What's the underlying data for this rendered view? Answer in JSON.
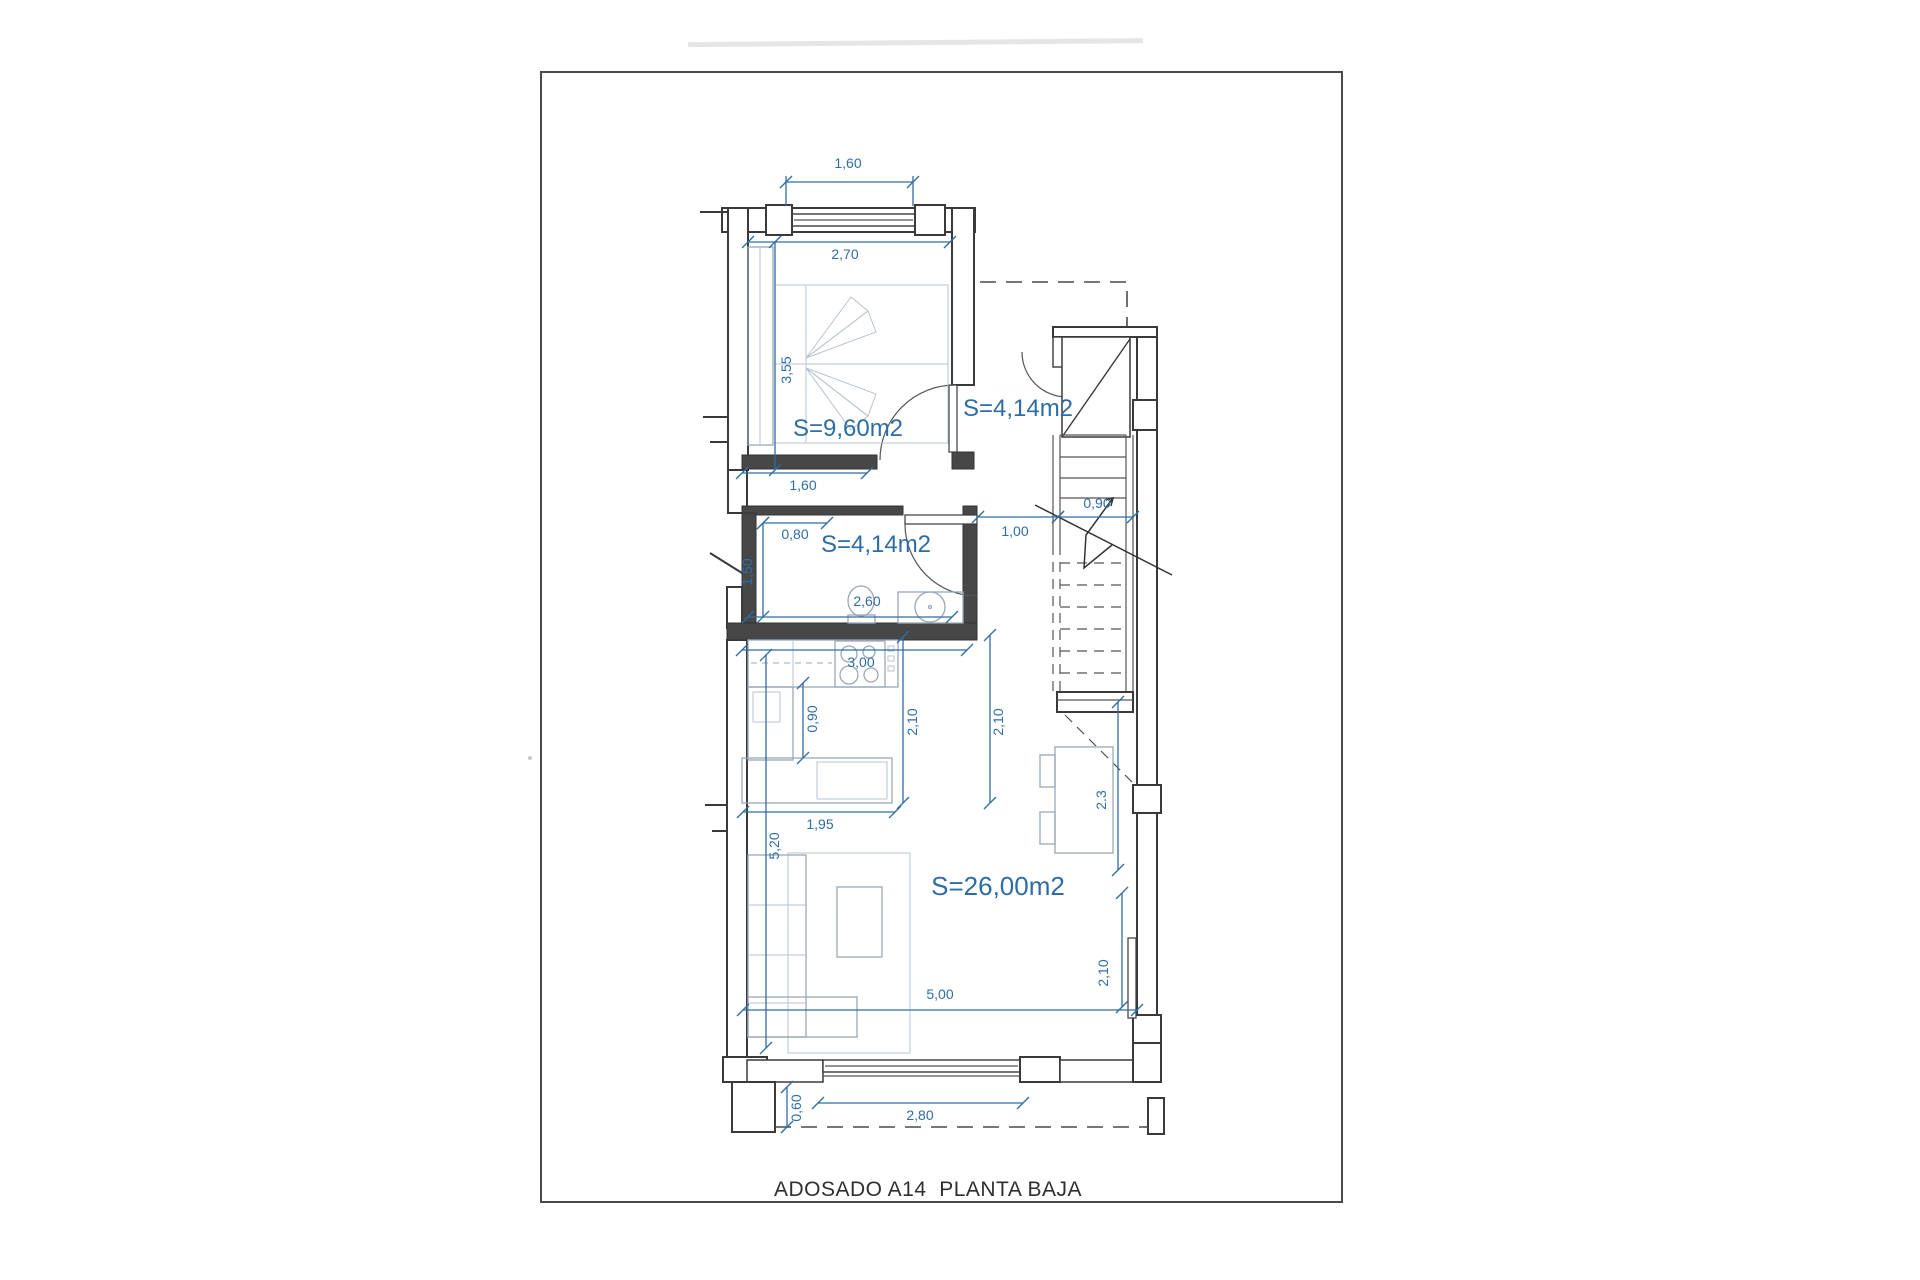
{
  "page": {
    "title": "ADOSADO A14  PLANTA BAJA"
  },
  "colors": {
    "dimension_blue": "#2e6da4",
    "wall_dark": "#474747",
    "furniture_gray": "#9aa7b6",
    "paper_white": "#ffffff"
  },
  "rooms": {
    "bedroom": {
      "area_label": "S=9,60m2"
    },
    "hall": {
      "area_label": "S=4,14m2"
    },
    "bathroom": {
      "area_label": "S=4,14m2"
    },
    "living_kitchen": {
      "area_label": "S=26,00m2"
    }
  },
  "dimensions": {
    "bedroom_window_width": "1,60",
    "bedroom_width": "2,70",
    "bedroom_depth": "3,55",
    "bedroom_lower_wall": "1,60",
    "bath_entry_offset": "0,80",
    "bath_depth": "1,50",
    "bath_width": "2,60",
    "hall_passage": "1,00",
    "stair_width": "0,90",
    "kitchen_width": "3,00",
    "kitchen_aisle": "0,90",
    "kitchen_depth_left": "2,10",
    "kitchen_depth_right": "2,10",
    "kitchen_run": "1,95",
    "living_depth": "5,20",
    "dining_depth": "2.3",
    "rear_window_height": "2,10",
    "living_width": "5,00",
    "terrace_step": "0,60",
    "terrace_window_width": "2,80"
  }
}
